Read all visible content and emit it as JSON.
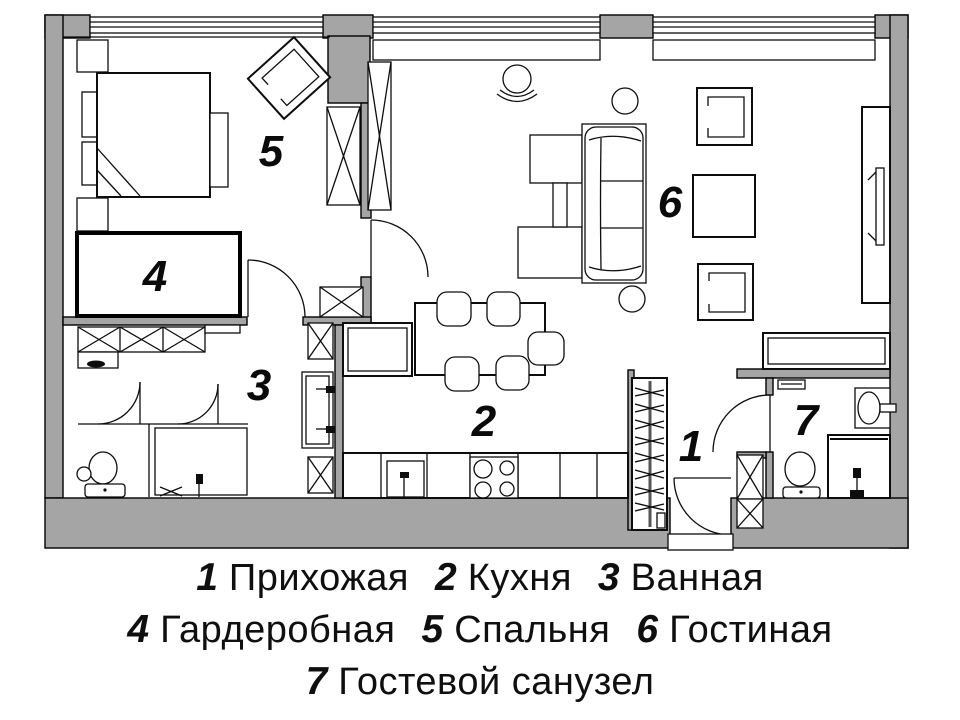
{
  "title": "Apartment floor plan",
  "rooms": [
    {
      "number": "1",
      "label": "Прихожая"
    },
    {
      "number": "2",
      "label": "Кухня"
    },
    {
      "number": "3",
      "label": "Ванная"
    },
    {
      "number": "4",
      "label": "Гардеробная"
    },
    {
      "number": "5",
      "label": "Спальня"
    },
    {
      "number": "6",
      "label": "Гостиная"
    },
    {
      "number": "7",
      "label": "Гостевой санузел"
    }
  ],
  "colors": {
    "wall": "#a5a5a5",
    "line": "#0d0d0d",
    "background": "#ffffff"
  }
}
